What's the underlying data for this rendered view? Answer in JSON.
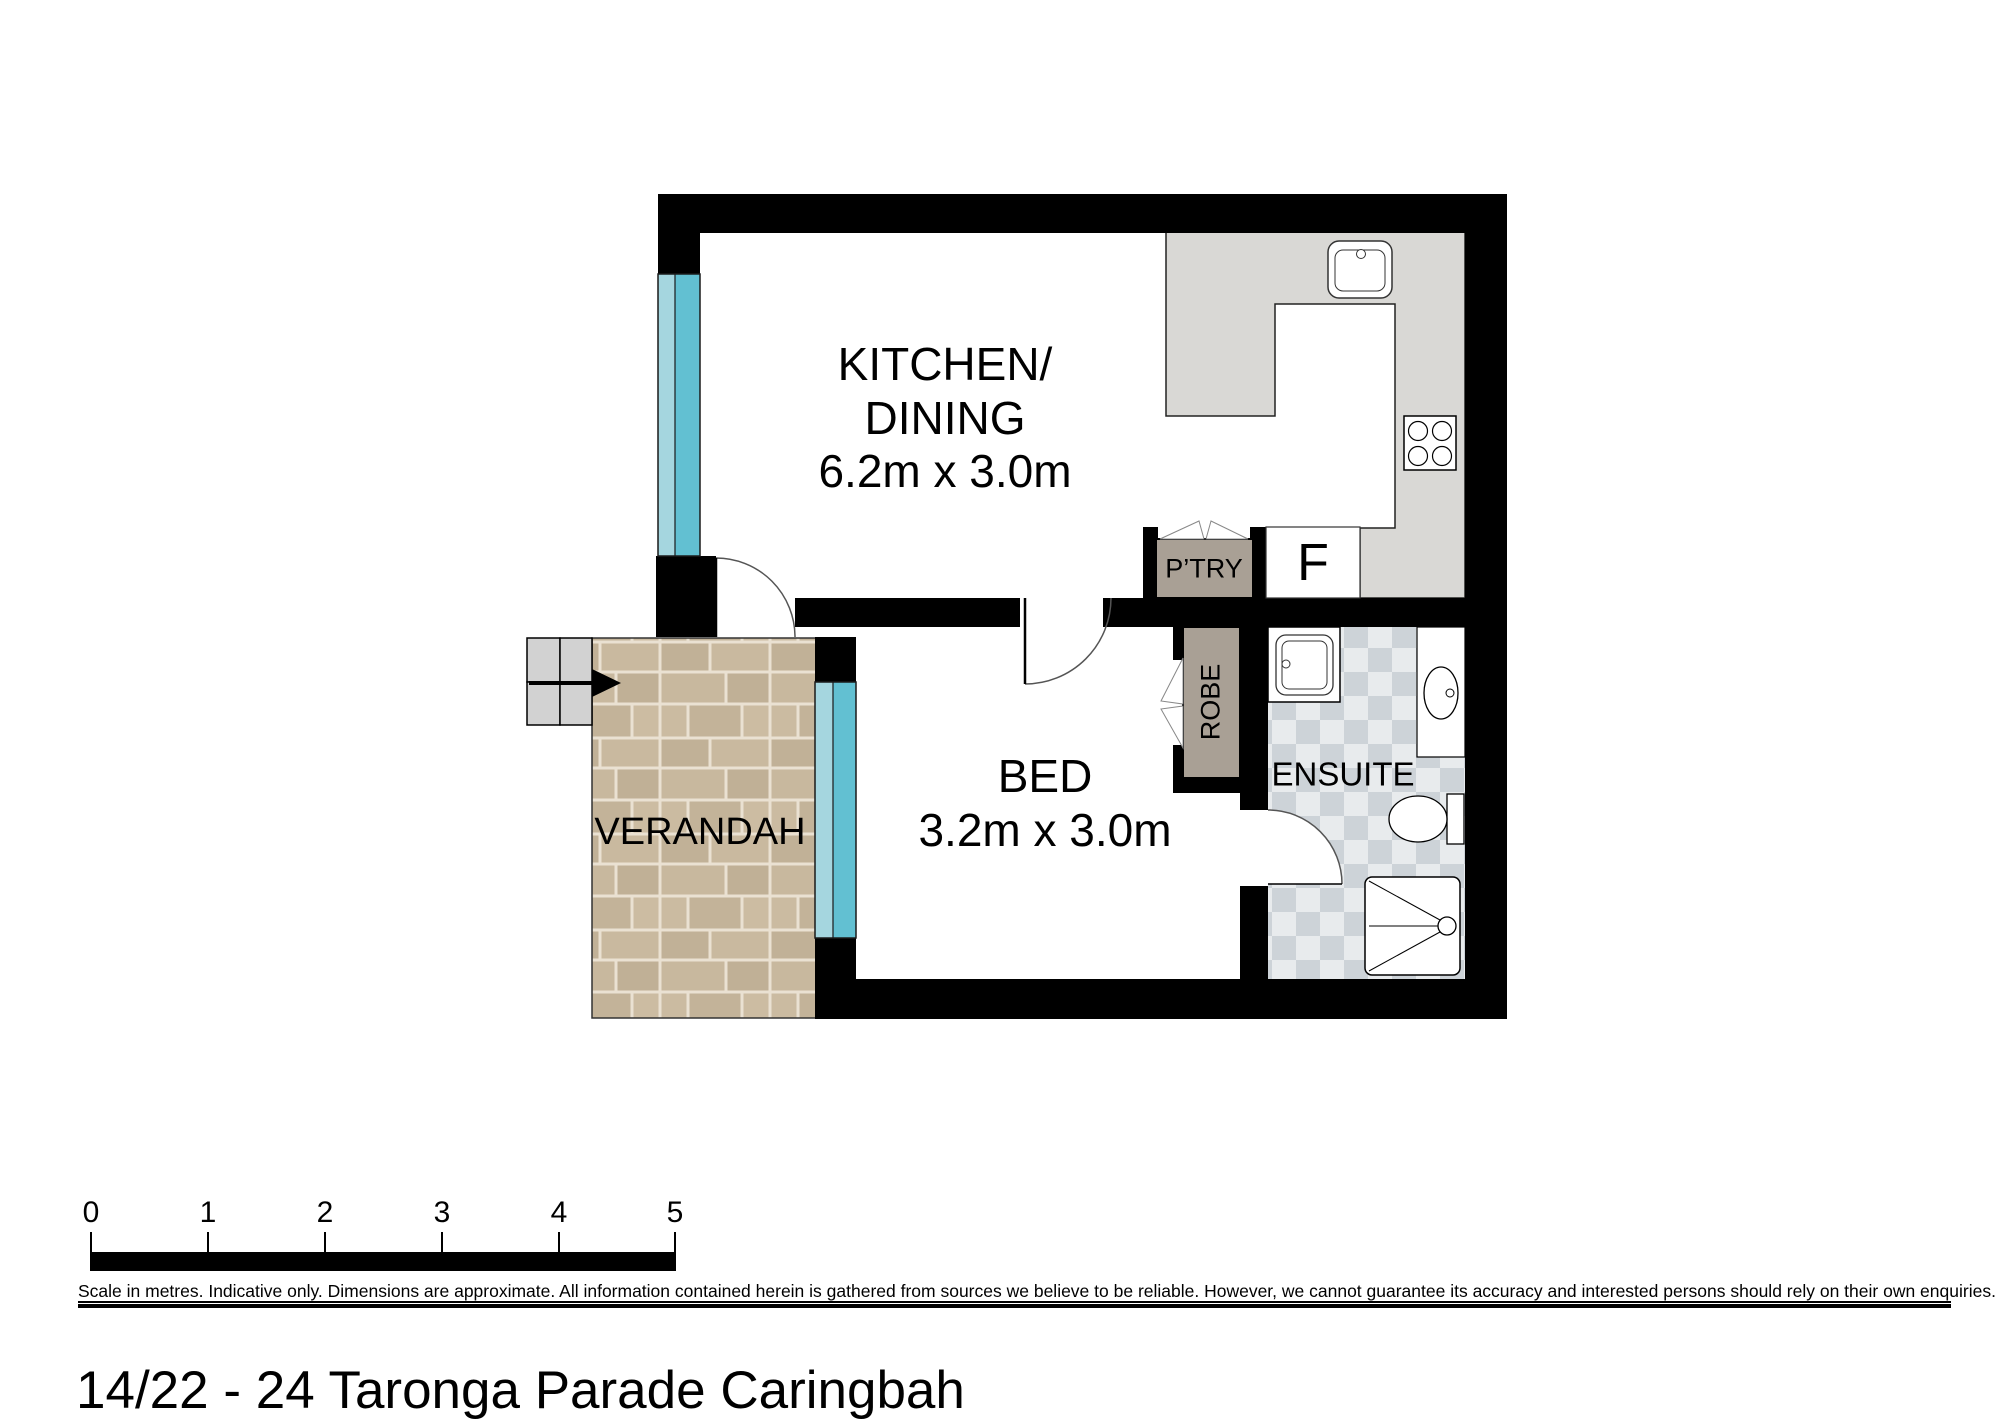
{
  "address": "14/22 - 24 Taronga Parade Caringbah",
  "rooms": {
    "kitchen_dining": {
      "name_line1": "KITCHEN/",
      "name_line2": "DINING",
      "dims": "6.2m x 3.0m"
    },
    "bed": {
      "name": "BED",
      "dims": "3.2m x 3.0m"
    },
    "verandah": {
      "name": "VERANDAH"
    },
    "ensuite": {
      "name": "ENSUITE"
    },
    "pantry": {
      "name": "P’TRY"
    },
    "robe": {
      "name": "ROBE"
    },
    "fridge": {
      "name": "F"
    }
  },
  "scale_bar": {
    "ticks": [
      "0",
      "1",
      "2",
      "3",
      "4",
      "5"
    ]
  },
  "disclaimer": "Scale in metres. Indicative only. Dimensions are approximate. All information contained herein is gathered from sources we believe to be reliable. However, we cannot guarantee its accuracy and interested persons should rely on their own enquiries.",
  "colors": {
    "wall": "#000000",
    "window_light": "#a5d6df",
    "window_dark": "#62c0d2",
    "cabinet_taupe": "#a9a095",
    "counter_gray": "#d9d8d5",
    "steps_gray": "#d2d2d2",
    "tile_light": "#e8ebed",
    "tile_dark": "#cdd3d8",
    "paver_tan": "#c6b69c"
  }
}
